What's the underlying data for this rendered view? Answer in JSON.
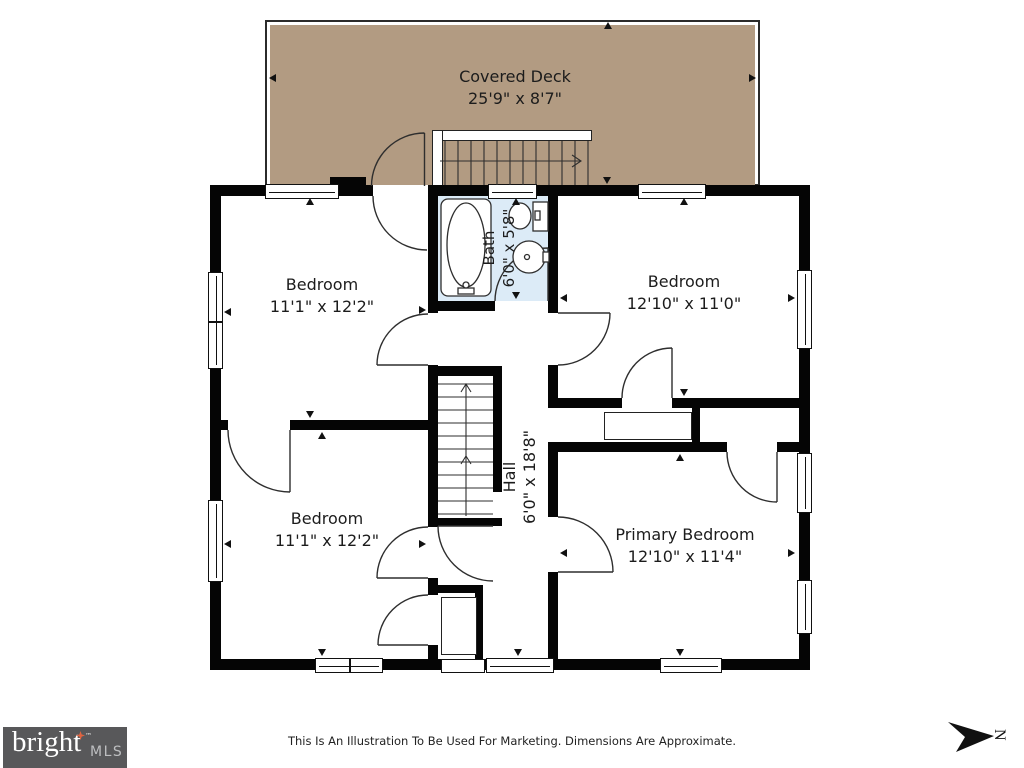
{
  "rooms": [
    {
      "name": "Covered Deck",
      "dims": "25'9\" x 8'7\""
    },
    {
      "name": "Bedroom",
      "dims": "11'1\" x 12'2\""
    },
    {
      "name": "Bedroom",
      "dims": "12'10\" x 11'0\""
    },
    {
      "name": "Bath",
      "dims": "6'0\" x 5'8\""
    },
    {
      "name": "Hall",
      "dims": "6'0\" x 18'8\""
    },
    {
      "name": "Bedroom",
      "dims": "11'1\" x 12'2\""
    },
    {
      "name": "Primary Bedroom",
      "dims": "12'10\" x 11'4\""
    }
  ],
  "footer": {
    "disclaimer": "This Is An Illustration To Be Used For Marketing. Dimensions Are Approximate."
  },
  "branding": {
    "logo_text": "bright",
    "logo_tm": "™",
    "logo_suffix": "MLS"
  },
  "compass": {
    "label": "N"
  },
  "colors": {
    "deck_fill": "#b29b82",
    "bath_fill": "#dcebf7",
    "wall": "#050505",
    "line": "#2e2e2e",
    "logo_bg": "#58585a",
    "logo_accent": "#df6340",
    "text": "#1c1c1c"
  }
}
